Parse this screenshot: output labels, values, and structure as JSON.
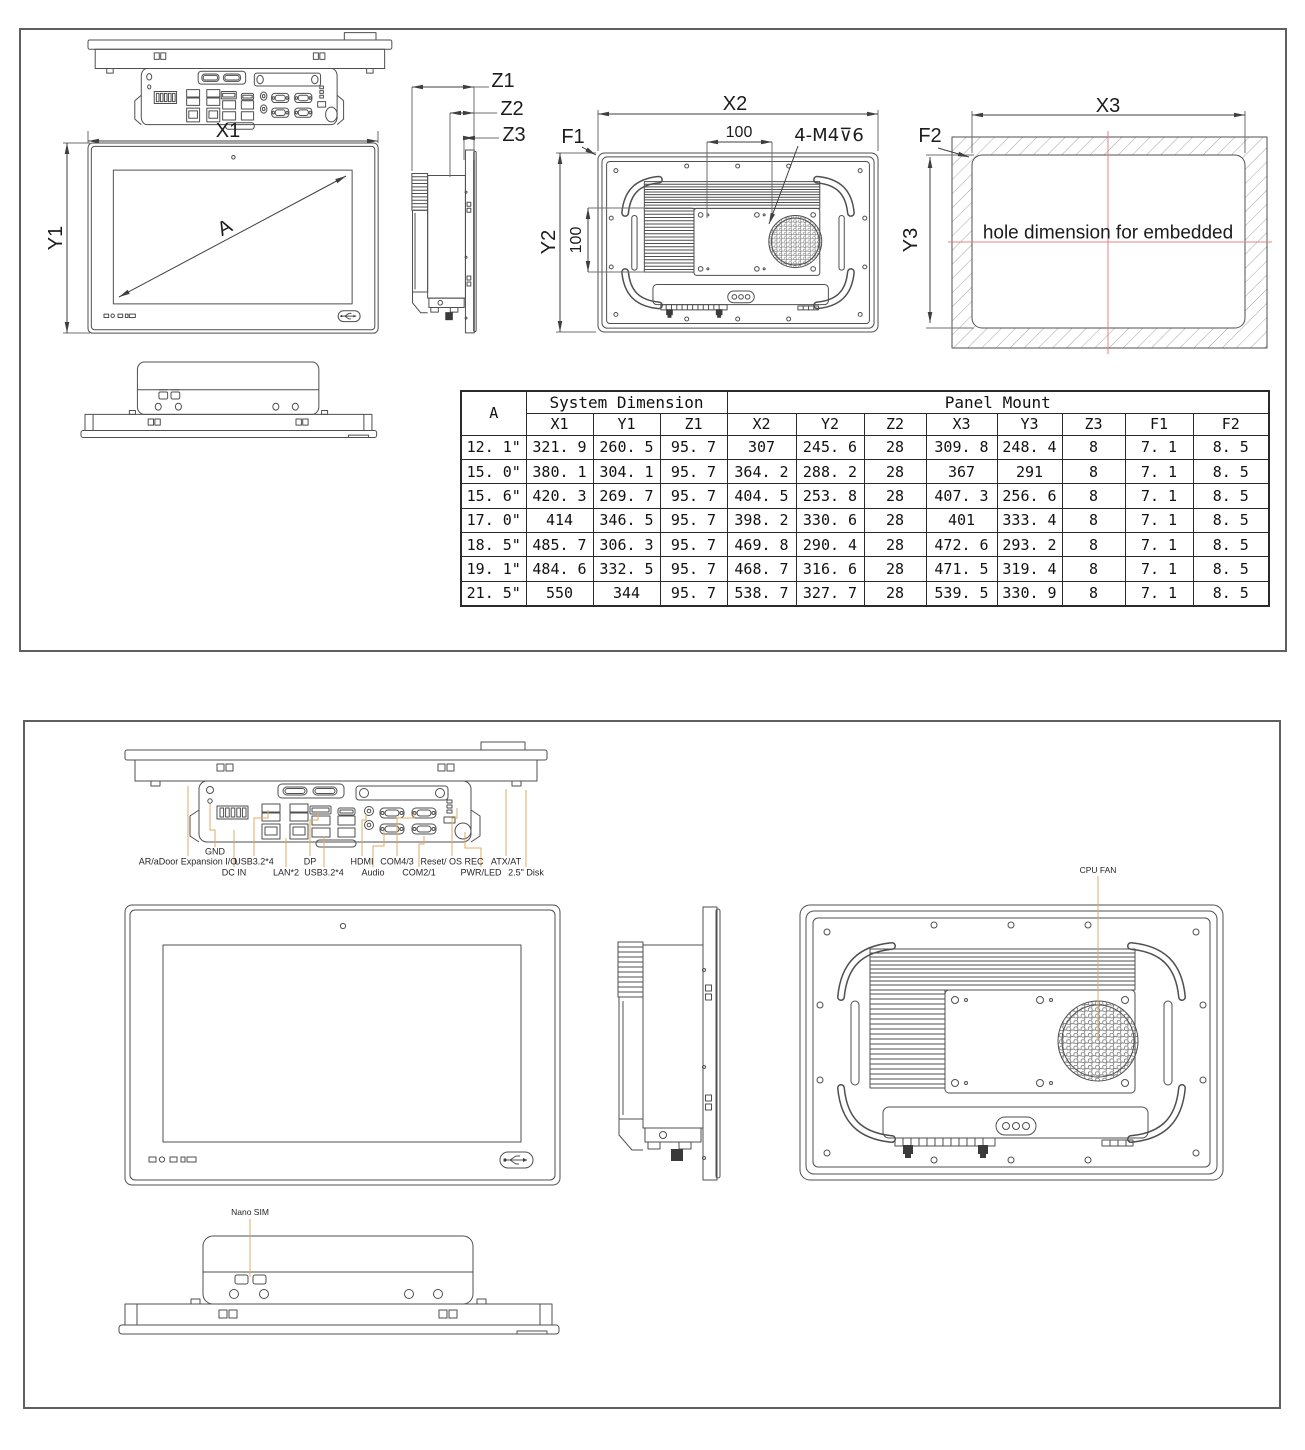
{
  "colors": {
    "background": "#ffffff",
    "sheet_border": "#5f5f5f",
    "drawing_line": "#4f4f4f",
    "dimension_line": "#3f3f3f",
    "leader_line": "#e0ab66",
    "centerline_red": "#e08585",
    "text": "#1c1c1c"
  },
  "sheet1": {
    "dims": {
      "x1": "X1",
      "y1": "Y1",
      "diag": "A",
      "z1": "Z1",
      "z2": "Z2",
      "z3": "Z3",
      "x2": "X2",
      "y2": "Y2",
      "vesa_h": "100",
      "vesa_v": "100",
      "f1": "F1",
      "thread": "4-M4⊽6",
      "x3": "X3",
      "y3": "Y3",
      "f2": "F2"
    },
    "hole_note": "hole dimension for embedded",
    "table": {
      "corner": "A",
      "group_system": "System Dimension",
      "group_panel": "Panel Mount",
      "columns": [
        "X1",
        "Y1",
        "Z1",
        "X2",
        "Y2",
        "Z2",
        "X3",
        "Y3",
        "Z3",
        "F1",
        "F2"
      ],
      "rows": [
        {
          "size": "12. 1\"",
          "x1": "321. 9",
          "y1": "260. 5",
          "z1": "95. 7",
          "x2": "307",
          "y2": "245. 6",
          "z2": "28",
          "x3": "309. 8",
          "y3": "248. 4",
          "z3": "8",
          "f1": "7. 1",
          "f2": "8. 5"
        },
        {
          "size": "15. 0\"",
          "x1": "380. 1",
          "y1": "304. 1",
          "z1": "95. 7",
          "x2": "364. 2",
          "y2": "288. 2",
          "z2": "28",
          "x3": "367",
          "y3": "291",
          "z3": "8",
          "f1": "7. 1",
          "f2": "8. 5"
        },
        {
          "size": "15. 6\"",
          "x1": "420. 3",
          "y1": "269. 7",
          "z1": "95. 7",
          "x2": "404. 5",
          "y2": "253. 8",
          "z2": "28",
          "x3": "407. 3",
          "y3": "256. 6",
          "z3": "8",
          "f1": "7. 1",
          "f2": "8. 5"
        },
        {
          "size": "17. 0\"",
          "x1": "414",
          "y1": "346. 5",
          "z1": "95. 7",
          "x2": "398. 2",
          "y2": "330. 6",
          "z2": "28",
          "x3": "401",
          "y3": "333. 4",
          "z3": "8",
          "f1": "7. 1",
          "f2": "8. 5"
        },
        {
          "size": "18. 5\"",
          "x1": "485. 7",
          "y1": "306. 3",
          "z1": "95. 7",
          "x2": "469. 8",
          "y2": "290. 4",
          "z2": "28",
          "x3": "472. 6",
          "y3": "293. 2",
          "z3": "8",
          "f1": "7. 1",
          "f2": "8. 5"
        },
        {
          "size": "19. 1\"",
          "x1": "484. 6",
          "y1": "332. 5",
          "z1": "95. 7",
          "x2": "468. 7",
          "y2": "316. 6",
          "z2": "28",
          "x3": "471. 5",
          "y3": "319. 4",
          "z3": "8",
          "f1": "7. 1",
          "f2": "8. 5"
        },
        {
          "size": "21. 5\"",
          "x1": "550",
          "y1": "344",
          "z1": "95. 7",
          "x2": "538. 7",
          "y2": "327. 7",
          "z2": "28",
          "x3": "539. 5",
          "y3": "330. 9",
          "z3": "8",
          "f1": "7. 1",
          "f2": "8. 5"
        }
      ]
    }
  },
  "sheet2": {
    "io_labels": {
      "gnd": "GND",
      "ar_adoor": "AR/aDoor Expansion I/O",
      "usb_top": "USB3.2*4",
      "dp": "DP",
      "hdmi": "HDMI",
      "com43": "COM4/3",
      "reset": "Reset/ OS REC",
      "atx": "ATX/AT",
      "dc_in": "DC IN",
      "lan": "LAN*2",
      "usb_bottom": "USB3.2*4",
      "audio": "Audio",
      "com21": "COM2/1",
      "pwr": "PWR/LED",
      "disk": "2.5\" Disk"
    },
    "cpu_fan": "CPU FAN",
    "nano_sim": "Nano SIM"
  }
}
